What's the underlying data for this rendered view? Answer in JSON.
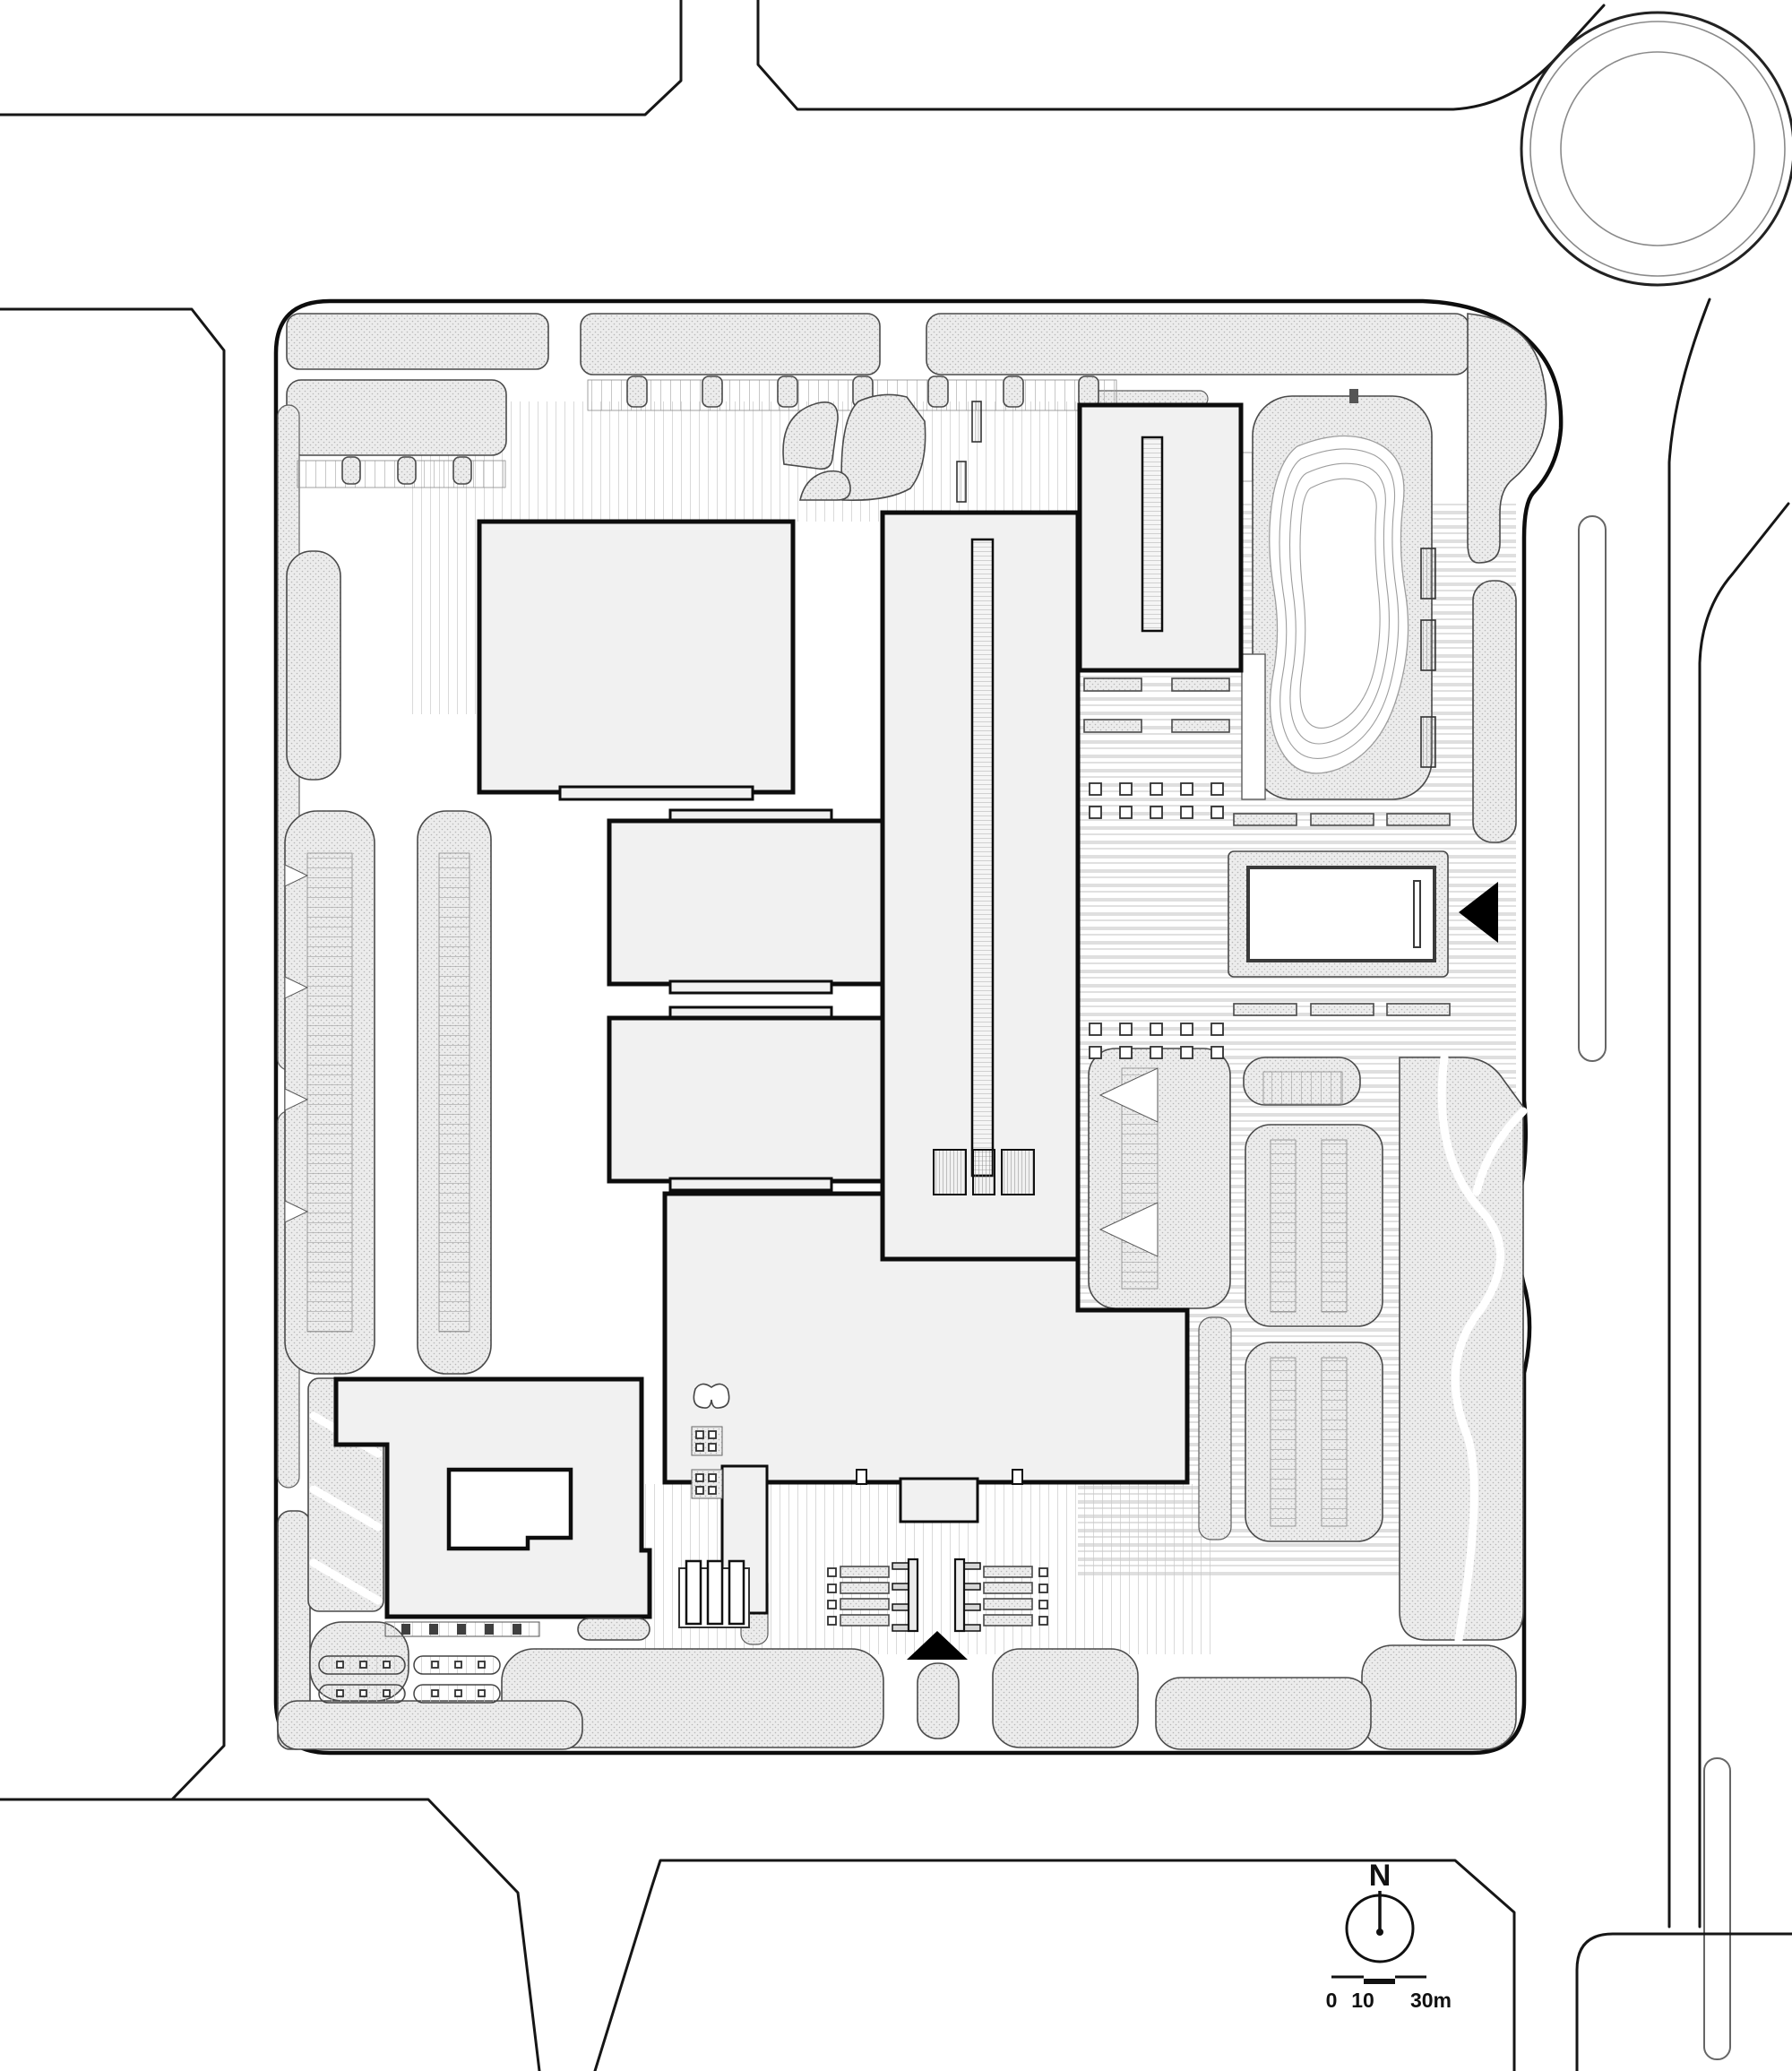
{
  "drawing": {
    "kind": "architectural-site-plan",
    "north_indicator": {
      "label": "N"
    },
    "scale_bar": {
      "labels": [
        "0",
        "10",
        "30m"
      ]
    },
    "entrance_icons": {
      "south_arrow": "filled-triangle-up",
      "east_arrow": "filled-triangle-left"
    },
    "colors": {
      "paper": "#ffffff",
      "linework": "#161616",
      "building_fill": "#f1f1f1",
      "building_outline": "#0d0d0d",
      "landscape_bg": "#ececec",
      "landscape_dot": "#b7b7b7",
      "paving_stripe": "#c9c9c9",
      "water_contour": "#9e9e9e",
      "arrow_fill": "#000000"
    }
  }
}
